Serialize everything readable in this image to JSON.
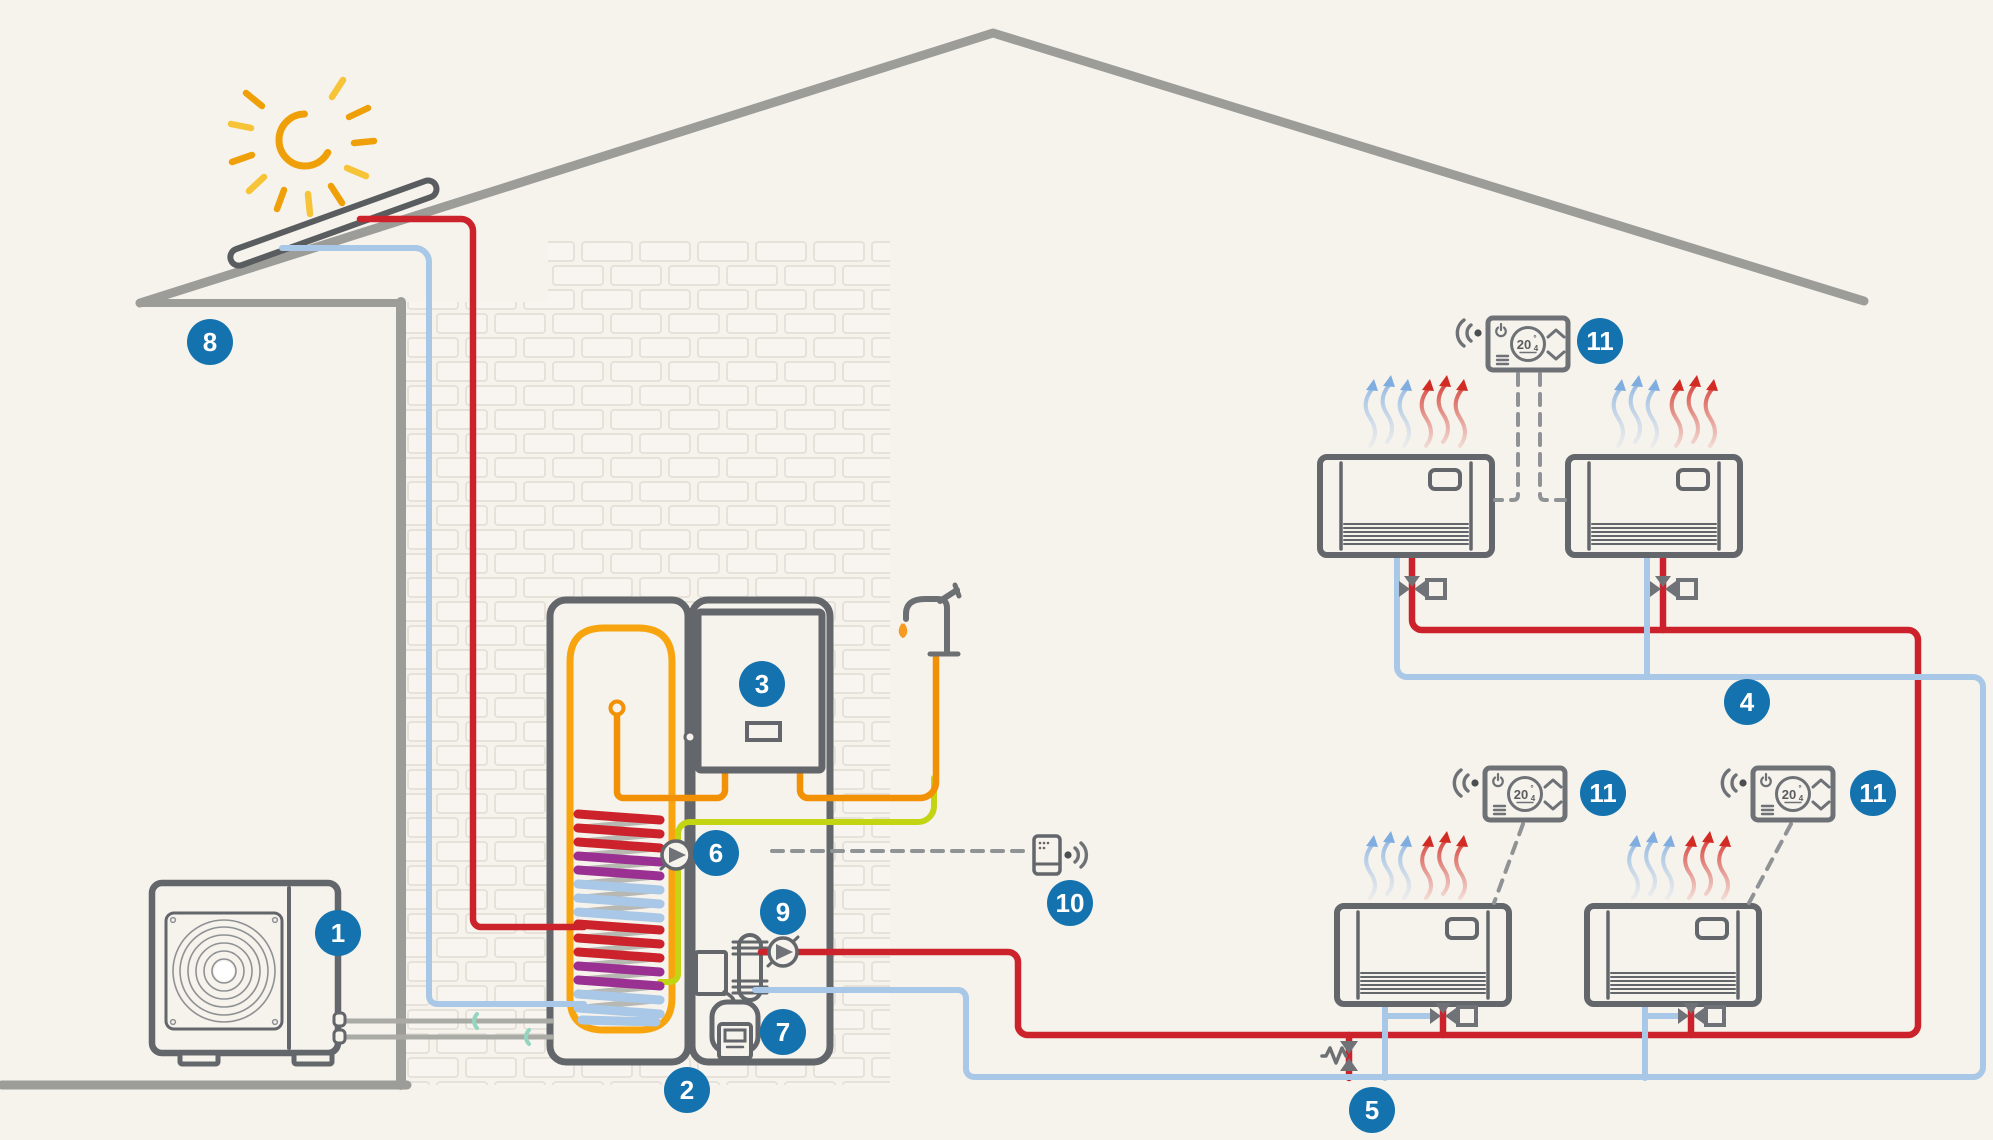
{
  "badges": {
    "b1": "1",
    "b2": "2",
    "b3": "3",
    "b4": "4",
    "b5": "5",
    "b6": "6",
    "b7": "7",
    "b8": "8",
    "b9": "9",
    "b10": "10",
    "b11a": "11",
    "b11b": "11",
    "b11c": "11"
  },
  "thermostat": {
    "main": "20",
    "degree": "°",
    "decimal": "4",
    "display_full": "20.4°"
  },
  "colors": {
    "background": "#f6f2ec",
    "structure_gray": "#9c9c99",
    "appliance_gray": "#63666a",
    "pipe_red": "#cc222b",
    "pipe_blue": "#a9c7e6",
    "pipe_orange": "#f29105",
    "pipe_lime": "#c3d412",
    "coil_purple": "#9a3192",
    "badge_blue": "#1473ae",
    "sun_amber": "#efa008",
    "sun_yellow": "#f7c437"
  },
  "icons": [
    "sun-icon",
    "solar-panel",
    "roof",
    "house-wall",
    "ground-line",
    "outdoor-heat-pump-unit",
    "fan-icon",
    "refrigerant-lines",
    "hot-water-tank",
    "solar-coil",
    "heating-coil",
    "tank-sensor-icon",
    "backup-boiler-unit",
    "circulation-pump-icon",
    "plate-heat-exchanger-icon",
    "expansion-vessel-meter",
    "faucet-icon",
    "water-drop-icon",
    "wireless-gateway-icon",
    "wifi-signal-icon",
    "fan-coil-unit",
    "zone-valve-icon",
    "bypass-valve-icon",
    "thermostat",
    "power-icon",
    "menu-icon",
    "chevron-up-icon",
    "chevron-down-icon",
    "cool-air-arrows",
    "warm-air-arrows"
  ]
}
